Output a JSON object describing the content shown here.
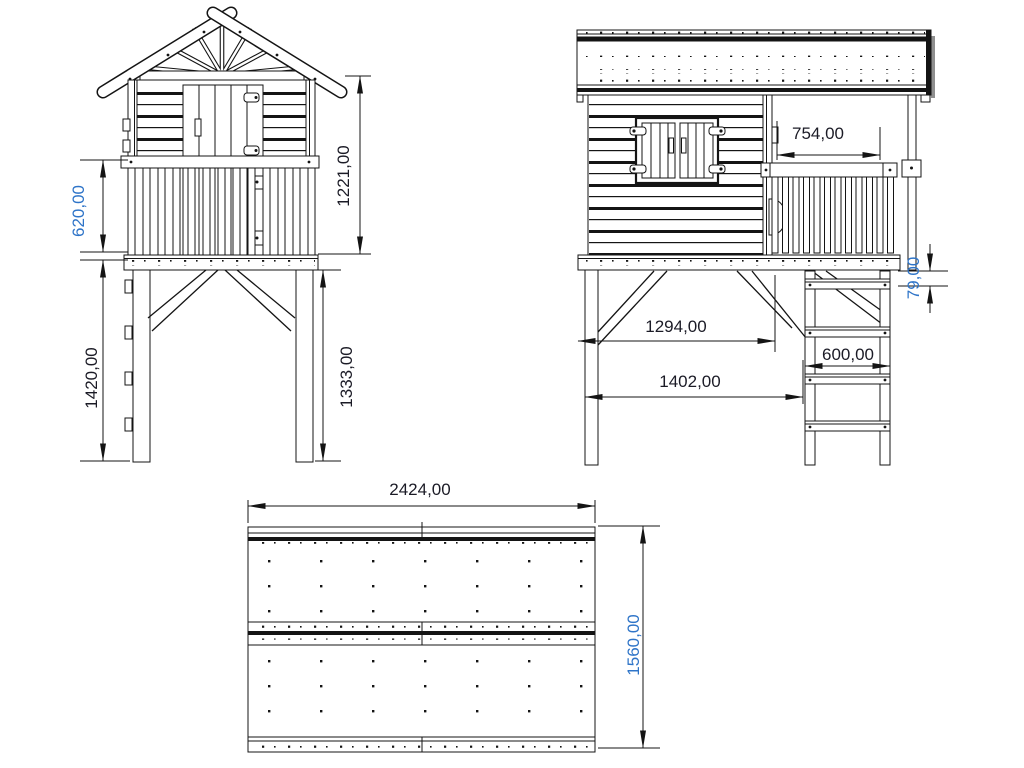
{
  "drawing": {
    "type": "technical-drawing",
    "subject": "stilted playhouse with ladder - three orthographic views",
    "front": {
      "rail_height": "620,00",
      "cabin_height": "1221,00",
      "left_leg_height": "1420,00",
      "right_leg_height": "1333,00"
    },
    "side": {
      "porch_width": "754,00",
      "step_offset": "79,00",
      "brace_span": "1294,00",
      "base_length": "1402,00",
      "ladder_width": "600,00"
    },
    "top": {
      "roof_length": "2424,00",
      "roof_width": "1560,00"
    },
    "colors": {
      "line": "#141414",
      "dim_default": "#1b1b26",
      "dim_highlight": "#2e74c8",
      "background": "#ffffff",
      "roof_shadow": "#8f8f8f"
    }
  }
}
